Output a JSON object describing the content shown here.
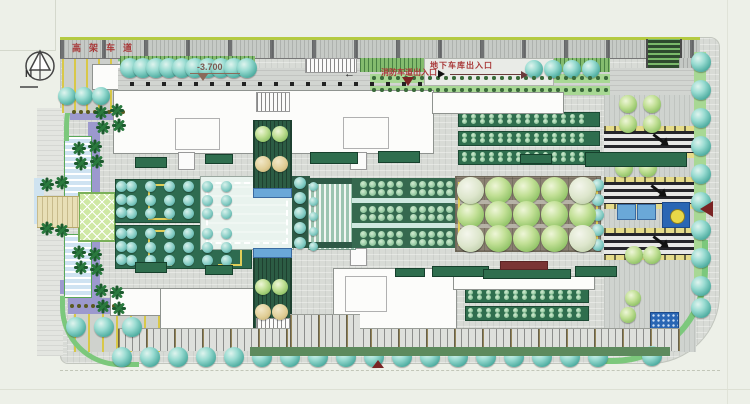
{
  "labels": {
    "north": "N",
    "elevated_road": "高架车道",
    "elevation": "-3.700",
    "garage_entrance": "地下车库出入口",
    "fire_lane_entrance": "消防车道出入口"
  },
  "colors": {
    "background": "#edf0e8",
    "paving": "#d8dbd6",
    "band_edge": "#b4ca42",
    "hedge_green": "#2f6e4e",
    "tree_teal": "#56b2a6",
    "tree_lime": "#92c468",
    "pool_blue": "#9edade",
    "water_blue": "#6aa8d8",
    "fountain_blue": "#2a66b4",
    "fountain_yellow": "#e8d848",
    "purple_canopy": "#9c99ce",
    "walk_beige": "#e8dfb6",
    "accent_red": "#a83838",
    "marker_red": "#7a2424",
    "yellow_line": "#d8c848"
  },
  "features": {
    "tree_rows": [
      {
        "k": "teal",
        "x": 130,
        "y": 68,
        "dx": 13,
        "n": 10,
        "r": 10
      },
      {
        "k": "teal",
        "x": 534,
        "y": 69,
        "dx": 19,
        "n": 4,
        "r": 9
      },
      {
        "k": "teal",
        "x": 67,
        "y": 96,
        "dx": 17,
        "n": 3,
        "r": 9
      },
      {
        "k": "teal",
        "x": 701,
        "y": 62,
        "dy": 28,
        "n": 9,
        "r": 10
      },
      {
        "k": "teal",
        "x": 701,
        "y": 308,
        "r": 10
      },
      {
        "k": "teal",
        "x": 652,
        "y": 356,
        "r": 10
      },
      {
        "k": "teal",
        "x": 122,
        "y": 357,
        "dx": 28,
        "n": 18,
        "r": 10
      },
      {
        "k": "teal",
        "x": 76,
        "y": 327,
        "dx": 28,
        "n": 3,
        "r": 10
      },
      {
        "k": "cyan",
        "x": 131,
        "y": 186,
        "dx": 19,
        "n": 6,
        "r": 5.5
      },
      {
        "k": "cyan",
        "x": 131,
        "y": 200,
        "dx": 19,
        "n": 6,
        "r": 5.5
      },
      {
        "k": "cyan",
        "x": 131,
        "y": 213,
        "dx": 19,
        "n": 6,
        "r": 5.5
      },
      {
        "k": "cyan",
        "x": 131,
        "y": 233,
        "dx": 19,
        "n": 6,
        "r": 5.5
      },
      {
        "k": "cyan",
        "x": 131,
        "y": 247,
        "dx": 19,
        "n": 6,
        "r": 5.5
      },
      {
        "k": "cyan",
        "x": 131,
        "y": 260,
        "dx": 19,
        "n": 6,
        "r": 5.5
      },
      {
        "k": "cyan",
        "x": 121,
        "y": 186,
        "dy": 13,
        "n": 3,
        "r": 5.5
      },
      {
        "k": "cyan",
        "x": 121,
        "y": 233,
        "dy": 13,
        "n": 3,
        "r": 5.5
      },
      {
        "k": "cyan",
        "x": 300,
        "y": 183,
        "dy": 15,
        "n": 5,
        "r": 6
      },
      {
        "k": "cyan",
        "x": 313,
        "y": 186,
        "dy": 15,
        "n": 5,
        "r": 4.5
      },
      {
        "k": "cyan",
        "x": 598,
        "y": 185,
        "dy": 15,
        "n": 5,
        "r": 6
      },
      {
        "k": "mint",
        "x": 363,
        "y": 184,
        "dx": 9,
        "n": 5,
        "r": 3.5
      },
      {
        "k": "mint",
        "x": 413,
        "y": 184,
        "dx": 9,
        "n": 5,
        "r": 3.5
      },
      {
        "k": "mint",
        "x": 363,
        "y": 192,
        "dx": 9,
        "n": 5,
        "r": 3.5
      },
      {
        "k": "mint",
        "x": 413,
        "y": 192,
        "dx": 9,
        "n": 5,
        "r": 3.5
      },
      {
        "k": "mint",
        "x": 363,
        "y": 209,
        "dx": 9,
        "n": 5,
        "r": 3.5
      },
      {
        "k": "mint",
        "x": 413,
        "y": 209,
        "dx": 9,
        "n": 5,
        "r": 3.5
      },
      {
        "k": "mint",
        "x": 363,
        "y": 217,
        "dx": 9,
        "n": 5,
        "r": 3.5
      },
      {
        "k": "mint",
        "x": 413,
        "y": 217,
        "dx": 9,
        "n": 5,
        "r": 3.5
      },
      {
        "k": "mint",
        "x": 363,
        "y": 234,
        "dx": 9,
        "n": 5,
        "r": 3.5
      },
      {
        "k": "mint",
        "x": 413,
        "y": 234,
        "dx": 9,
        "n": 5,
        "r": 3.5
      },
      {
        "k": "mint",
        "x": 363,
        "y": 242,
        "dx": 9,
        "n": 5,
        "r": 3.5
      },
      {
        "k": "mint",
        "x": 413,
        "y": 242,
        "dx": 9,
        "n": 5,
        "r": 3.5
      },
      {
        "k": "lime",
        "x": 470,
        "y": 190,
        "dx": 28,
        "n": 5,
        "r": 13.5
      },
      {
        "k": "lime",
        "x": 470,
        "y": 214,
        "dx": 28,
        "n": 5,
        "r": 13.5
      },
      {
        "k": "lime",
        "x": 470,
        "y": 238,
        "dx": 28,
        "n": 5,
        "r": 13.5
      },
      {
        "k": "pale",
        "x": 470,
        "y": 190,
        "r": 13.5
      },
      {
        "k": "pale",
        "x": 582,
        "y": 190,
        "r": 13.5
      },
      {
        "k": "pale",
        "x": 470,
        "y": 238,
        "r": 13.5
      },
      {
        "k": "pale",
        "x": 582,
        "y": 238,
        "r": 13.5
      },
      {
        "k": "lime",
        "x": 628,
        "y": 104,
        "r": 9
      },
      {
        "k": "lime",
        "x": 652,
        "y": 104,
        "r": 9
      },
      {
        "k": "lime",
        "x": 628,
        "y": 124,
        "r": 9
      },
      {
        "k": "lime",
        "x": 652,
        "y": 124,
        "r": 9
      },
      {
        "k": "lime",
        "x": 624,
        "y": 168,
        "r": 9
      },
      {
        "k": "lime",
        "x": 648,
        "y": 168,
        "r": 9
      },
      {
        "k": "lime",
        "x": 634,
        "y": 255,
        "r": 9
      },
      {
        "k": "lime",
        "x": 652,
        "y": 255,
        "r": 9
      },
      {
        "k": "lime",
        "x": 633,
        "y": 298,
        "r": 8
      },
      {
        "k": "lime",
        "x": 628,
        "y": 315,
        "r": 8
      },
      {
        "k": "lime",
        "x": 263,
        "y": 134,
        "r": 8
      },
      {
        "k": "lime",
        "x": 280,
        "y": 134,
        "r": 8
      },
      {
        "k": "beige",
        "x": 263,
        "y": 164,
        "r": 8
      },
      {
        "k": "beige",
        "x": 280,
        "y": 164,
        "r": 8
      },
      {
        "k": "lime",
        "x": 263,
        "y": 287,
        "r": 8
      },
      {
        "k": "lime",
        "x": 280,
        "y": 287,
        "r": 8
      },
      {
        "k": "beige",
        "x": 263,
        "y": 312,
        "r": 8
      },
      {
        "k": "beige",
        "x": 280,
        "y": 312,
        "r": 8
      },
      {
        "k": "olive",
        "x": 74,
        "y": 112,
        "dx": 7,
        "n": 8,
        "r": 2.2
      },
      {
        "k": "olive",
        "x": 72,
        "y": 306,
        "dx": 7,
        "n": 8,
        "r": 2.2
      },
      {
        "k": "bk",
        "x": 132,
        "y": 84,
        "dx": 16,
        "n": 19,
        "r": 1.8
      },
      {
        "k": "dg",
        "x": 374,
        "y": 78,
        "dx": 8,
        "n": 30,
        "r": 1.7
      },
      {
        "k": "dg",
        "x": 374,
        "y": 90,
        "dx": 8,
        "n": 30,
        "r": 1.7
      },
      {
        "k": "mint",
        "x": 464,
        "y": 116,
        "dx": 9,
        "n": 14,
        "r": 2.5
      },
      {
        "k": "mint",
        "x": 464,
        "y": 121,
        "dx": 9,
        "n": 14,
        "r": 2.5
      },
      {
        "k": "mint",
        "x": 464,
        "y": 135,
        "dx": 9,
        "n": 14,
        "r": 2.5
      },
      {
        "k": "mint",
        "x": 464,
        "y": 140,
        "dx": 9,
        "n": 14,
        "r": 2.5
      },
      {
        "k": "mint",
        "x": 464,
        "y": 154,
        "dx": 9,
        "n": 14,
        "r": 2.5
      },
      {
        "k": "mint",
        "x": 464,
        "y": 159,
        "dx": 9,
        "n": 14,
        "r": 2.5
      },
      {
        "k": "mint",
        "x": 470,
        "y": 292,
        "dx": 9,
        "n": 13,
        "r": 2.5
      },
      {
        "k": "mint",
        "x": 470,
        "y": 297,
        "dx": 9,
        "n": 13,
        "r": 2.5
      },
      {
        "k": "mint",
        "x": 470,
        "y": 310,
        "dx": 9,
        "n": 13,
        "r": 2.5
      },
      {
        "k": "mint",
        "x": 470,
        "y": 315,
        "dx": 9,
        "n": 13,
        "r": 2.5
      }
    ],
    "palms": [
      [
        101,
        112
      ],
      [
        117,
        110
      ],
      [
        103,
        127
      ],
      [
        119,
        125
      ],
      [
        79,
        148
      ],
      [
        95,
        146
      ],
      [
        81,
        163
      ],
      [
        97,
        161
      ],
      [
        47,
        184
      ],
      [
        62,
        182
      ],
      [
        47,
        228
      ],
      [
        62,
        230
      ],
      [
        79,
        252
      ],
      [
        95,
        254
      ],
      [
        81,
        267
      ],
      [
        97,
        269
      ],
      [
        101,
        290
      ],
      [
        117,
        292
      ],
      [
        103,
        306
      ],
      [
        119,
        308
      ]
    ],
    "hedge_bars": [
      [
        135,
        157,
        30,
        9,
        "g"
      ],
      [
        205,
        154,
        26,
        8,
        "g"
      ],
      [
        310,
        152,
        46,
        10,
        "g"
      ],
      [
        378,
        151,
        40,
        10,
        "g"
      ],
      [
        520,
        154,
        30,
        8,
        "g"
      ],
      [
        585,
        152,
        100,
        13,
        "g"
      ],
      [
        135,
        262,
        30,
        9,
        "g"
      ],
      [
        205,
        265,
        26,
        8,
        "g"
      ],
      [
        395,
        268,
        28,
        7,
        "g"
      ],
      [
        432,
        266,
        55,
        9,
        "g"
      ],
      [
        483,
        269,
        86,
        8,
        "g"
      ],
      [
        575,
        266,
        40,
        9,
        "g"
      ],
      [
        500,
        261,
        46,
        7,
        "r"
      ],
      [
        250,
        347,
        420,
        9,
        "gl"
      ]
    ],
    "road_arrows": [
      [
        659,
        137
      ],
      [
        657,
        188
      ],
      [
        659,
        239
      ]
    ]
  }
}
